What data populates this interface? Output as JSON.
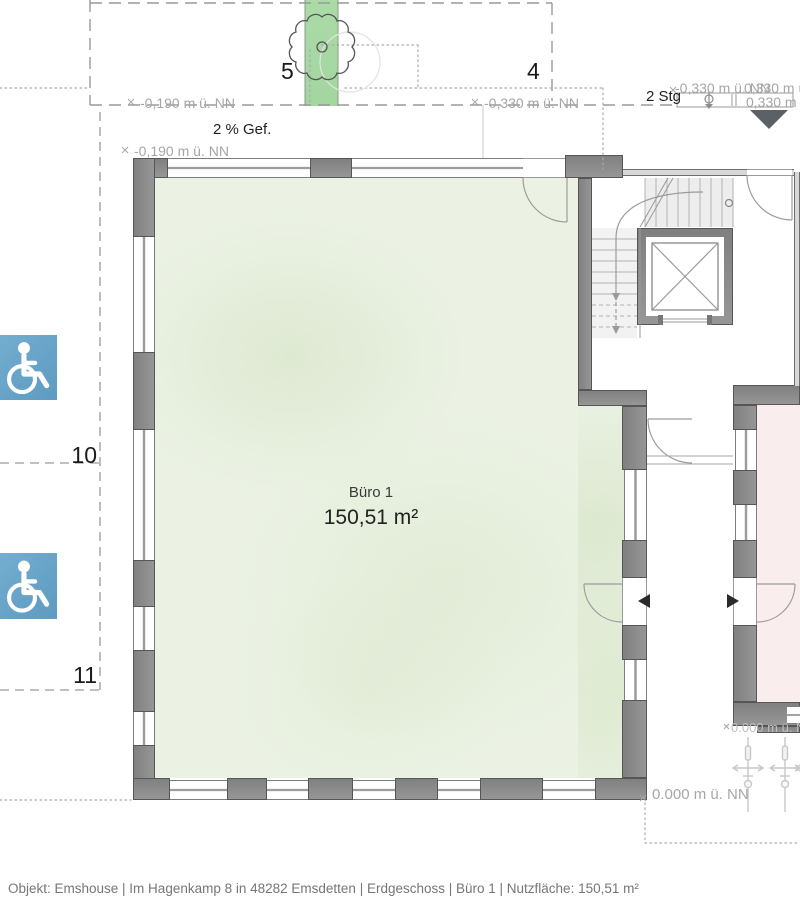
{
  "grid": {
    "col5": "5",
    "col4": "4",
    "row10": "10",
    "row11": "11"
  },
  "room": {
    "name": "Büro 1",
    "area": "150,51 m²"
  },
  "levels": {
    "minus190_top": "-0,190 m ü. NN",
    "minus190_wall": "-0,190 m ü. NN",
    "minus330_mid": "-0,330 m ü. NN",
    "minus330_right": "-0,330 m ü. NN",
    "plus330_upper": "0,330 m ü",
    "plus330_lower": "0,330 m ü",
    "zero_outside": "0.000 m ü. NN",
    "zero_clipped": "0.000 m ü. NN"
  },
  "notes": {
    "slope": "2 % Gef.",
    "steps": "2 Stg"
  },
  "footer": {
    "text": "Objekt: Emshouse | Im Hagenkamp 8 in 48282 Emsdetten | Erdgeschoss | Büro 1 | Nutzfläche: 150,51 m²"
  },
  "icons": {
    "wheelchair": "accessible-parking-sign",
    "tree": "tree-symbol",
    "entrance": "entrance-direction-marker",
    "benchmark": "level-benchmark-symbol",
    "plants": "planting-symbols",
    "elevator": "elevator-shaft-cross",
    "stairs": "stair-flights"
  },
  "colors": {
    "room_fill": "#ebf2e4",
    "adjacent_room_fill": "#f9eded",
    "planting_strip": "#a7d9a4",
    "wall": "#8e8e8e",
    "sign_blue": "#68a4c9",
    "marker_dark": "#5c6167",
    "annotation_gray": "#a6a6a6",
    "text_dark": "#1f1f1f",
    "footer_text": "#767676"
  }
}
